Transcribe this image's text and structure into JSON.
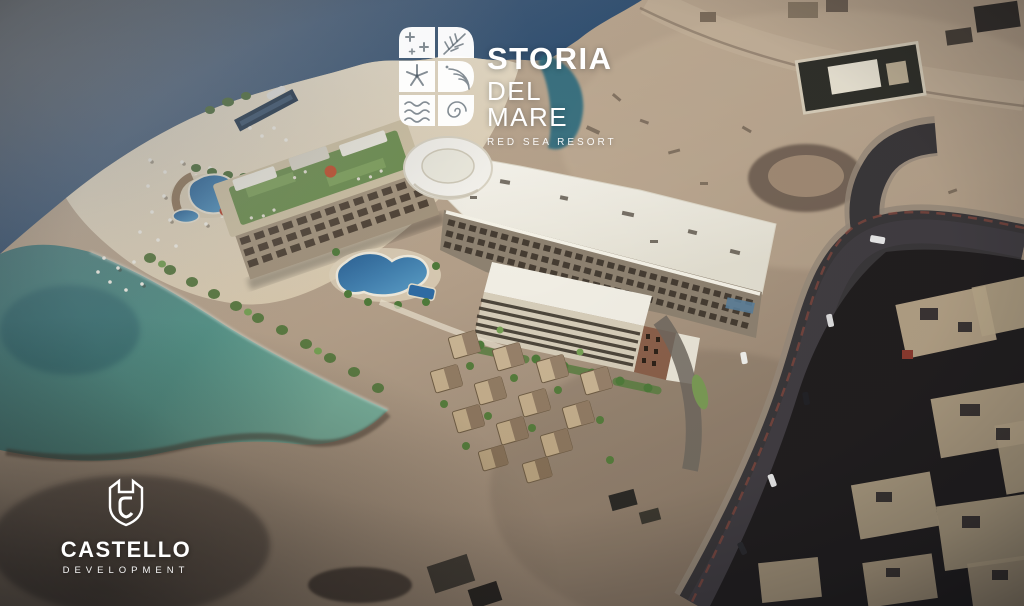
{
  "branding": {
    "resort_logo": {
      "icon": "storia-monogram-icon",
      "icon_description": "S-shaped monogram of six white tiles patterned with stars, palm leaf, starfish, arcs, waves and a spiral",
      "name": "STORIA",
      "subname": "DEL MARE",
      "tagline": "RED SEA RESORT",
      "color": "#ffffff"
    },
    "developer_logo": {
      "icon": "castello-shield-icon",
      "icon_description": "castle shield outline with letter C inside",
      "name": "CASTELLO",
      "subname": "DEVELOPMENT",
      "color": "#ffffff"
    }
  },
  "scene": {
    "kind": "aerial architectural rendering of a beachfront resort",
    "colors": {
      "deep_sea": "#2e4f72",
      "hazy_sea": "#70767c",
      "cove_teal": "#2f6d80",
      "shallow_water": "#5d9a8f",
      "beach_sand": "#eee5d0",
      "desert_sand": "#b4a089",
      "roof_white": "#f4f1e8",
      "facade_beige": "#a3937c",
      "window_dark": "#45392d",
      "rooftop_green": "#6d8f4f",
      "pool_blue": "#2f6fa8",
      "accent_red": "#c0512f",
      "road_asphalt": "#3a3739",
      "city_dark": "#211e1f",
      "city_roof_tan": "#b9a78a"
    }
  }
}
